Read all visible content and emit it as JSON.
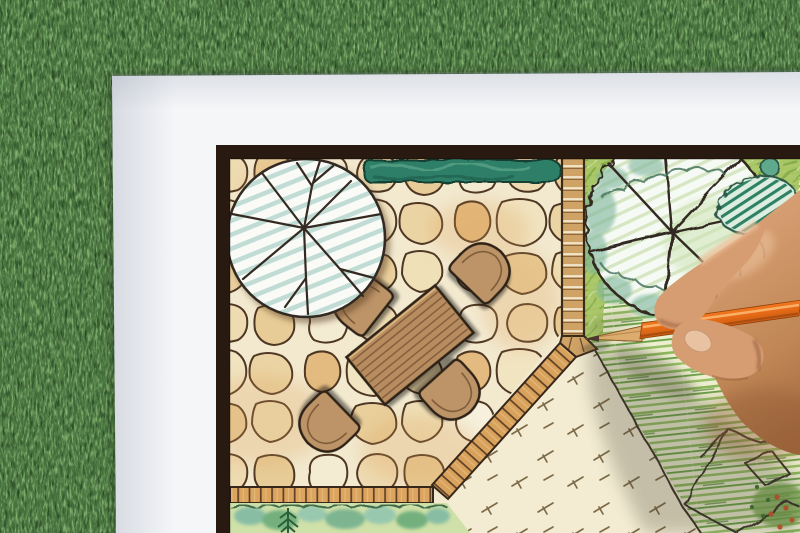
{
  "scene": {
    "type": "photograph",
    "description": "Close-up photo of a hand holding an orange colored pencil, drawing a hand-rendered garden landscape plan on a white sheet of paper that lies on green artificial turf",
    "view": "top-down oblique"
  },
  "colors": {
    "grass": "#46713d",
    "grass_light": "#7fae6c",
    "grass_pale": "#b4d09c",
    "grass_dark": "#22401f",
    "paper": "#f5f6f8",
    "frame": "#281a10",
    "stone_gap": "#f2e9cf",
    "stone_outline": "#4d3623",
    "hedge": "#2e7f68",
    "tree1_hatch": "#b9d8d0",
    "walkway": "#cfa265",
    "brick": "#dca45f",
    "table": "#b78c5e",
    "chair": "#bc9467",
    "ink_outline": "#2f2318",
    "lawn_base": "#edefd0",
    "lawn_stroke": "#8cb85c",
    "bed_green": "#a9c765",
    "shrub_stripe": "#2f8164",
    "gravel": "#f3ecd2",
    "pencil_orange": "#f57d22",
    "pencil_wood": "#dcab6e",
    "pencil_tip": "#483a2c",
    "skin": "#d79d72",
    "skin_shadow": "#a9714b",
    "cast_shadow": "#3f3a2e"
  },
  "plan": {
    "elements": [
      {
        "name": "deciduous-tree-symbol",
        "style": "circle with radial branch lines and teal pencil hatching"
      },
      {
        "name": "clipped-hedge",
        "style": "dark teal scribbled strip along top edge"
      },
      {
        "name": "flagstone-patio",
        "style": "irregular tan stones with dark joints"
      },
      {
        "name": "dining-table",
        "style": "rotated plank-top rectangle"
      },
      {
        "name": "patio-chairs",
        "count": 4,
        "style": "round-back chair symbols facing table"
      },
      {
        "name": "tile-walkway",
        "style": "ladder of small pavers with 45-degree corner"
      },
      {
        "name": "brick-edging",
        "style": "single course of small bricks bordering patio"
      },
      {
        "name": "shrub-border",
        "style": "watercolor shrubs with conifer sprig, bottom edge"
      },
      {
        "name": "shade-tree-symbol",
        "style": "large scalloped-canopy circle with spokes"
      },
      {
        "name": "hatched-shrub",
        "style": "cloud outline filled with green stripes"
      },
      {
        "name": "lawn",
        "style": "horizontal green pencil strokes"
      },
      {
        "name": "gravel-area",
        "style": "cream field with short dash marks"
      },
      {
        "name": "rock-garden",
        "style": "angular boulder outlines with flower dots, bottom right"
      }
    ]
  },
  "photo": {
    "hand": "right hand gripping pencil, entering from right edge",
    "pencil": "orange colored pencil, tip touching walkway corner of the drawing"
  }
}
